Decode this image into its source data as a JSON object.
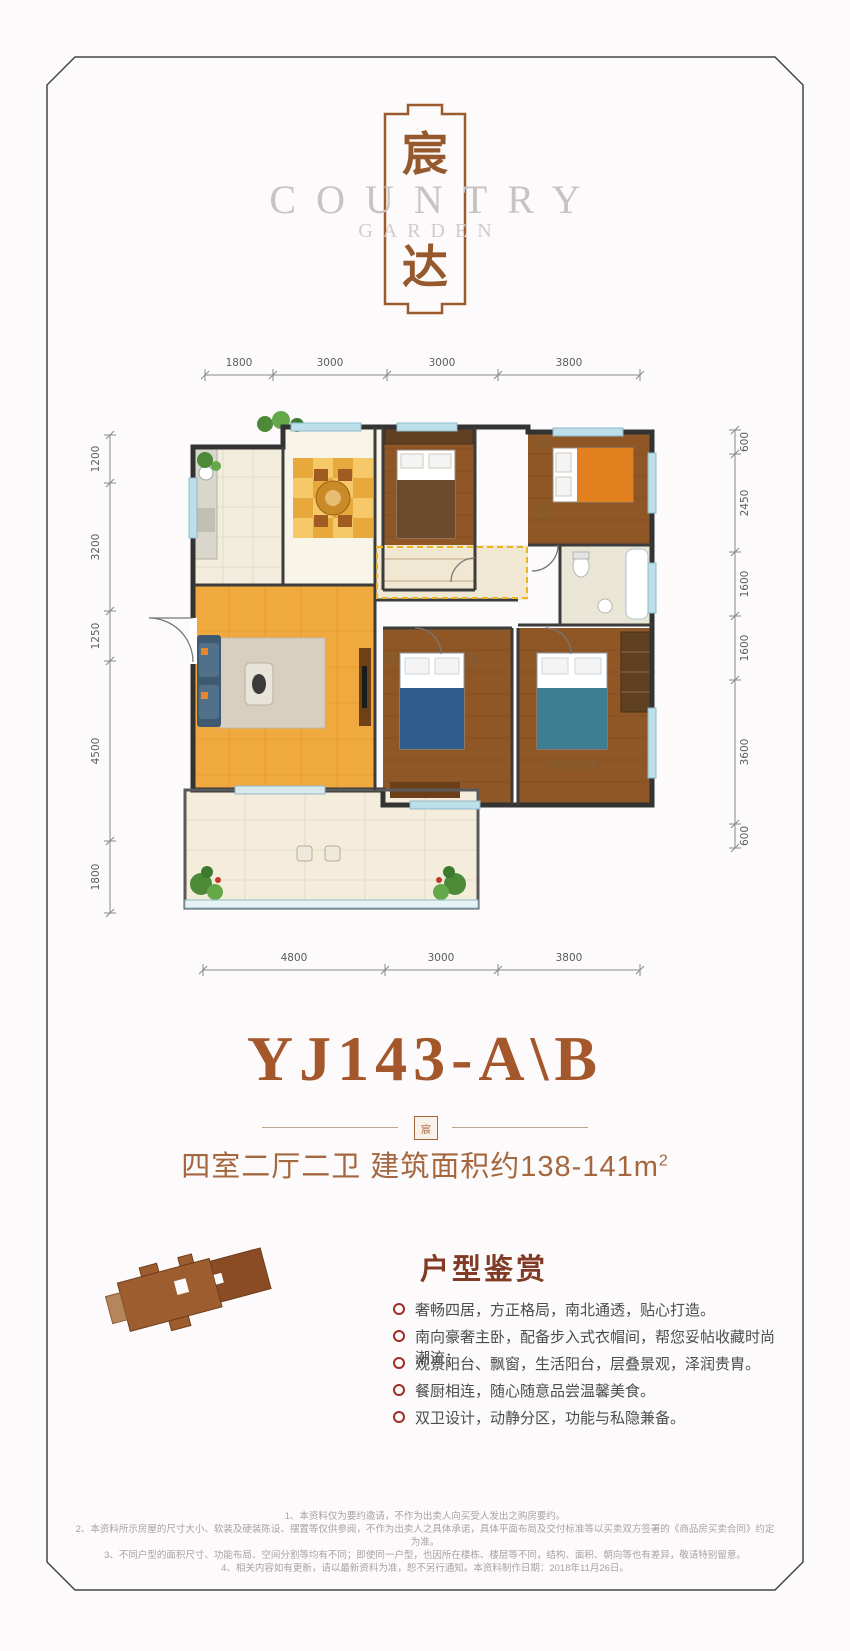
{
  "colors": {
    "accent_brown": "#a4572b",
    "logo_frame": "#9b5b2e",
    "bullet_red": "#9e2d26",
    "heading_maroon": "#803a25",
    "latin_gray": "#c6c4c2"
  },
  "logo": {
    "hanzi_top": "宸",
    "hanzi_bottom": "达",
    "english_line1": "COUNTRY",
    "english_line2": "GARDEN",
    "stamp_char": "宸"
  },
  "floorplan": {
    "dims_top": [
      "1800",
      "3000",
      "3000",
      "3800"
    ],
    "dims_bottom": [
      "4800",
      "3000",
      "3800"
    ],
    "dims_left": [
      "1200",
      "3200",
      "1250",
      "4500",
      "1800"
    ],
    "dims_right": [
      "600",
      "2450",
      "1600",
      "1600",
      "3600",
      "600"
    ]
  },
  "unit": {
    "model": "YJ143-A\\B",
    "spec": "四室二厅二卫  建筑面积约138-141m",
    "spec_sup": "2"
  },
  "features": {
    "heading": "户型鉴赏",
    "items": [
      "奢畅四居，方正格局，南北通透，贴心打造。",
      "南向豪奢主卧，配备步入式衣帽间，帮您妥帖收藏时尚潮流；",
      "观景阳台、飘窗，生活阳台，层叠景观，泽润贵胄。",
      "餐厨相连，随心随意品尝温馨美食。",
      "双卫设计，动静分区，功能与私隐兼备。"
    ]
  },
  "disclaimer": {
    "lines": [
      "1、本资料仅为要约邀请，不作为出卖人向买受人发出之购房要约。",
      "2、本资料所示房屋的尺寸大小、软装及硬装陈设、摆置等仅供参阅，不作为出卖人之具体承诺，具体平面布局及交付标准等以买卖双方签署的《商品房买卖合同》约定为准。",
      "3、不同户型的面积尺寸、功能布局、空间分割等均有不同；即使同一户型，也因所在楼栋、楼层等不同，结构、面积、朝向等也有差异，敬请特别留意。",
      "4、相关内容如有更新，请以最新资料为准，恕不另行通知。本资料制作日期：2018年11月26日。"
    ]
  }
}
